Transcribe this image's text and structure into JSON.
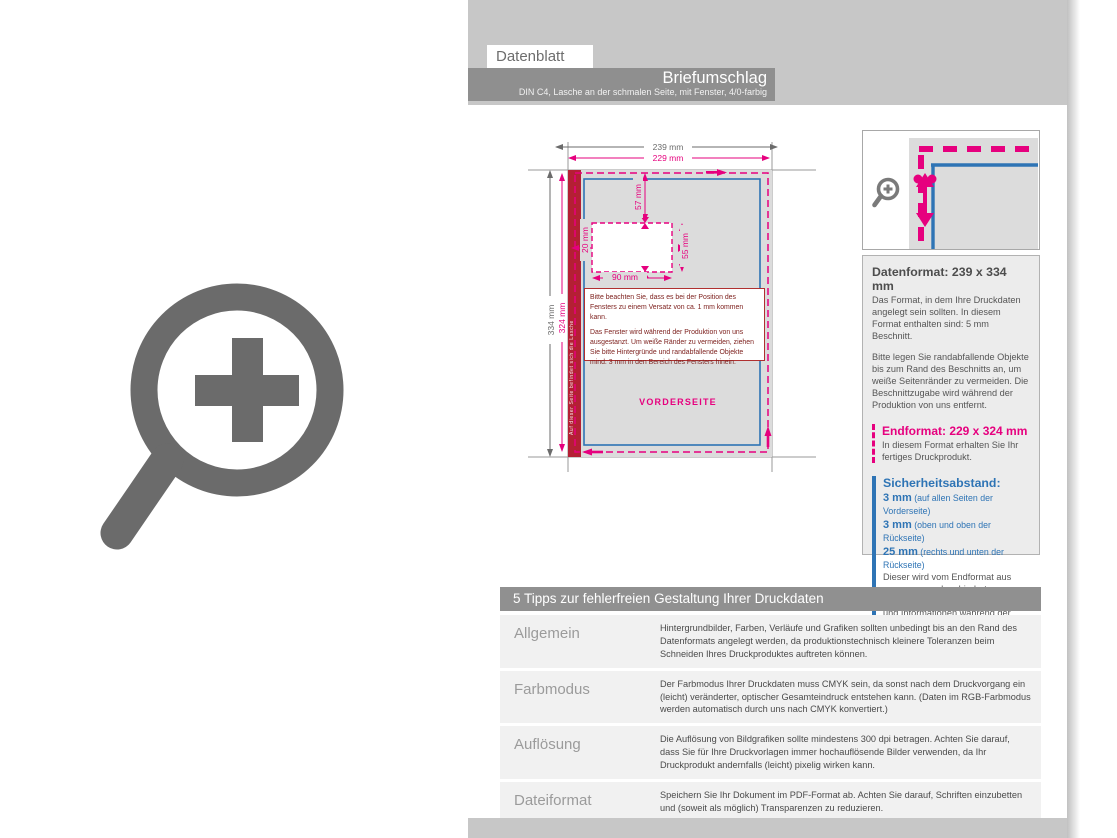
{
  "header": {
    "tab": "Datenblatt",
    "title": "Briefumschlag",
    "subtitle": "DIN C4, Lasche an der schmalen Seite, mit Fenster, 4/0-farbig"
  },
  "diagram": {
    "dims": {
      "outer_width": "239 mm",
      "inner_width": "229 mm",
      "outer_height": "334 mm",
      "inner_height": "324 mm",
      "window_top": "57 mm",
      "window_left": "20 mm",
      "window_width": "90 mm",
      "window_height": "55 mm"
    },
    "side_label": "VORDERSEITE",
    "flap_note": "Auf dieser Seite befindet sich die Lasche",
    "warning": {
      "para1": "Bitte beachten Sie, dass es bei der Position des Fensters zu einem Versatz von ca. 1 mm kommen kann.",
      "para2": "Das Fenster wird während der Produktion von uns ausgestanzt. Um weiße Ränder zu vermeiden, ziehen Sie bitte Hintergründe und randabfallende Objekte mind. 3 mm in den Bereich des Fensters hinein."
    }
  },
  "info_panel": {
    "datenformat": {
      "title": "Datenformat: 239 x 334 mm",
      "para1": "Das Format, in dem Ihre Druckdaten angelegt sein sollten. In diesem Format enthalten sind: 5 mm Beschnitt.",
      "para2": "Bitte legen Sie randabfallende Objekte bis zum Rand des Beschnitts an, um weiße Seitenränder zu vermeiden. Die Beschnittzugabe wird während der Produktion von uns entfernt."
    },
    "endformat": {
      "title": "Endformat: 229 x 324 mm",
      "body": "In diesem Format erhalten Sie Ihr fertiges Druckprodukt."
    },
    "sicherheitsabstand": {
      "title": "Sicherheitsabstand:",
      "lines": [
        {
          "value": "3 mm",
          "note": " (auf allen Seiten der Vorderseite)"
        },
        {
          "value": "3 mm",
          "note": " (oben und oben der Rückseite)"
        },
        {
          "value": "25 mm",
          "note": " (rechts und unten der Rückseite)"
        }
      ],
      "body": "Dieser wird vom Endformat aus gemessen und verhindert unerwünschten Anschnitt Ihrer Texte und Informationen während der Produktion."
    }
  },
  "tips": {
    "header": "5 Tipps zur fehlerfreien Gestaltung Ihrer Druckdaten",
    "rows": [
      {
        "label": "Allgemein",
        "body": "Hintergrundbilder, Farben, Verläufe und Grafiken sollten unbedingt bis an den Rand des Datenformats angelegt werden, da produktionstechnisch kleinere Toleranzen beim Schneiden Ihres Druckproduktes auftreten können."
      },
      {
        "label": "Farbmodus",
        "body": "Der Farbmodus Ihrer Druckdaten muss CMYK sein, da sonst nach dem Druckvorgang ein (leicht) veränderter, optischer Gesamteindruck entstehen kann. (Daten im RGB-Farbmodus werden automatisch durch uns nach CMYK konvertiert.)"
      },
      {
        "label": "Auflösung",
        "body": "Die Auflösung von Bildgrafiken sollte mindestens 300 dpi betragen. Achten Sie darauf, dass Sie für Ihre Druckvorlagen immer hochauflösende Bilder verwenden, da Ihr Druckprodukt andernfalls (leicht) pixelig wirken kann."
      },
      {
        "label": "Dateiformat",
        "body": "Speichern Sie Ihr Dokument im PDF-Format ab. Achten Sie darauf, Schriften einzubetten und (soweit als möglich) Transparenzen zu reduzieren."
      },
      {
        "label": "Seiten(-reihenfolge)",
        "body": "Senden Sie mehrseitige Dokumente chronologisch in korrekter Reihenfolge als eine einzige PDF-Datei oder benennen Sie Einzeldokumente entsprechend mit fortlaufenden Seitennummern."
      }
    ]
  },
  "colors": {
    "magenta_bleed": "#e6007e",
    "blue_safety": "#2e74b5",
    "flap_red": "#b41f34",
    "warning_red": "#b03030",
    "bar_gray": "#8f8f8f",
    "band_gray": "#c7c7c7",
    "envelope_gray": "#dcdcdc",
    "icon_gray": "#6b6b6b"
  }
}
